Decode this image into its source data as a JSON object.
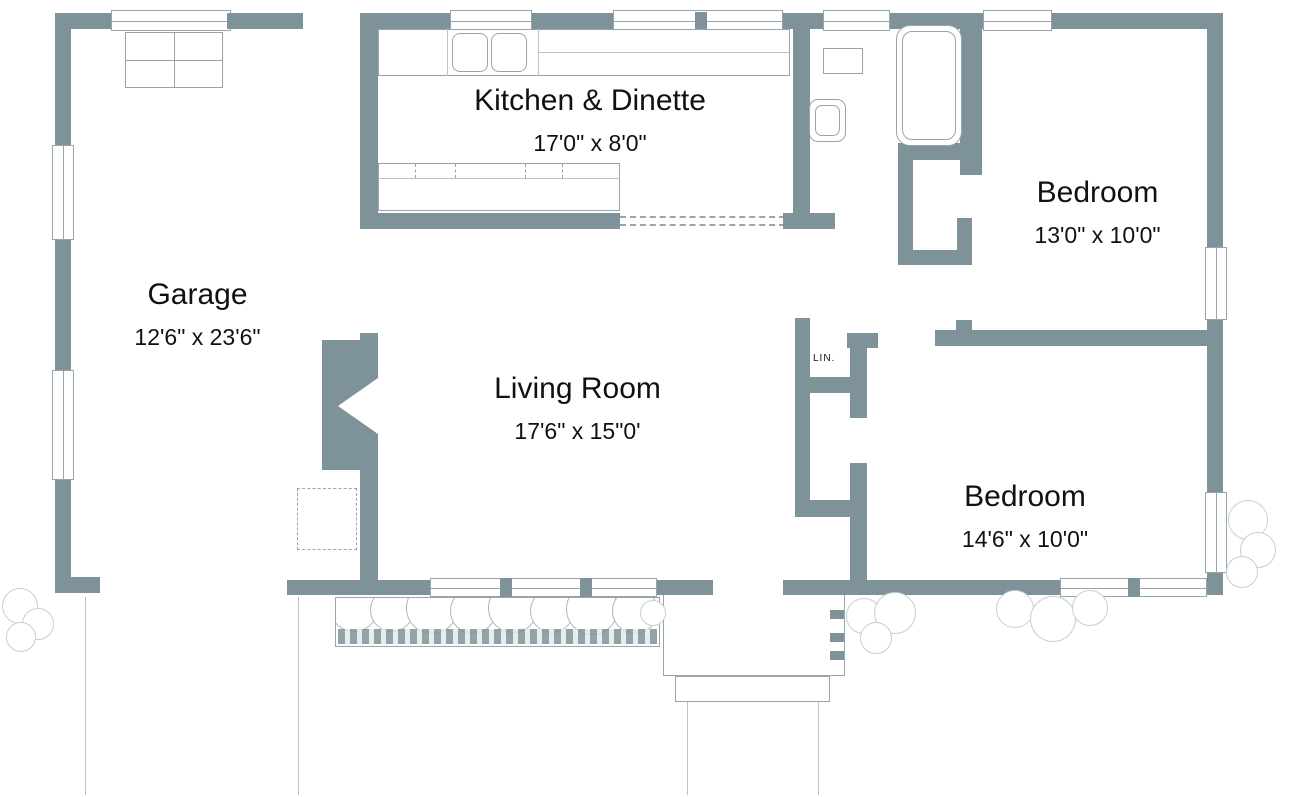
{
  "document_type": "residential floor plan",
  "rooms": [
    {
      "id": "garage",
      "name": "Garage",
      "dims": "12'6\" x 23'6\""
    },
    {
      "id": "kitchen",
      "name": "Kitchen & Dinette",
      "dims": "17'0\" x 8'0\""
    },
    {
      "id": "living_room",
      "name": "Living Room",
      "dims": "17'6\" x 15\"0'"
    },
    {
      "id": "bedroom_1",
      "name": "Bedroom",
      "dims": "13'0\" x 10'0\""
    },
    {
      "id": "bedroom_2",
      "name": "Bedroom",
      "dims": "14'6\" x 10'0\""
    }
  ],
  "closets": {
    "linen_label": "LIN."
  },
  "fixtures": [
    "bathtub",
    "toilet",
    "vanity",
    "double-sink",
    "kitchen-counter",
    "dinette-counter",
    "fireplace",
    "workbench",
    "front-porch",
    "front-step",
    "planter-box"
  ],
  "colors": {
    "wall": "#7e929a",
    "fixture_outline": "#98a5aa",
    "text": "#111111",
    "background": "#ffffff"
  }
}
